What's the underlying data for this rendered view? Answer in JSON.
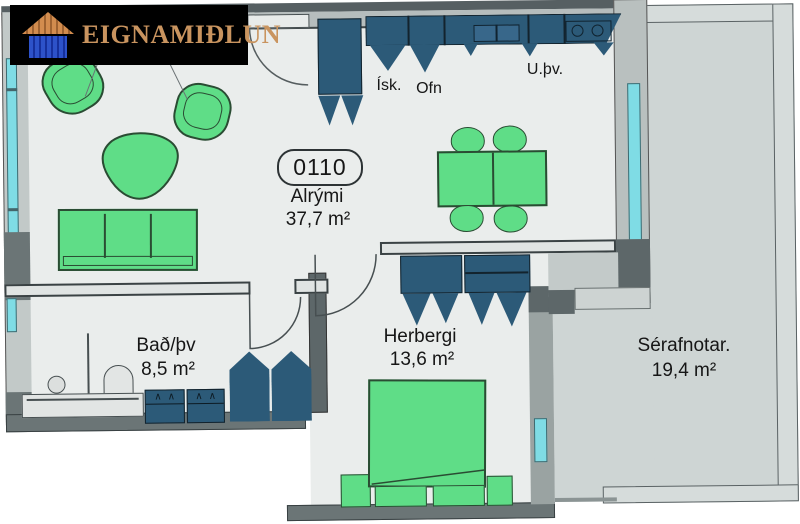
{
  "logo": {
    "text": "EIGNAMIÐLUN"
  },
  "unit": {
    "badge": "0110"
  },
  "rooms": {
    "alrymi": {
      "name": "Alrými",
      "area": "37,7 m²"
    },
    "bad": {
      "name": "Bað/þv",
      "area": "8,5 m²"
    },
    "herbergi": {
      "name": "Herbergi",
      "area": "13,6 m²"
    },
    "serafnotar": {
      "name": "Sérafnotar.",
      "area": "19,4 m²"
    }
  },
  "kitchen": {
    "fridge": "Ísk.",
    "oven": "Ofn",
    "dishwasher": "U.þv."
  },
  "colors": {
    "furniture_green": "#5fdd87",
    "cabinet_teal": "#2c5a78",
    "window_glass": "#7fdce5",
    "wall_gray": "#9aa3a2",
    "floor": "#eaedec",
    "terrace_floor": "#ced5d4",
    "logo_bg": "#000000",
    "logo_text": "#c9945f"
  }
}
